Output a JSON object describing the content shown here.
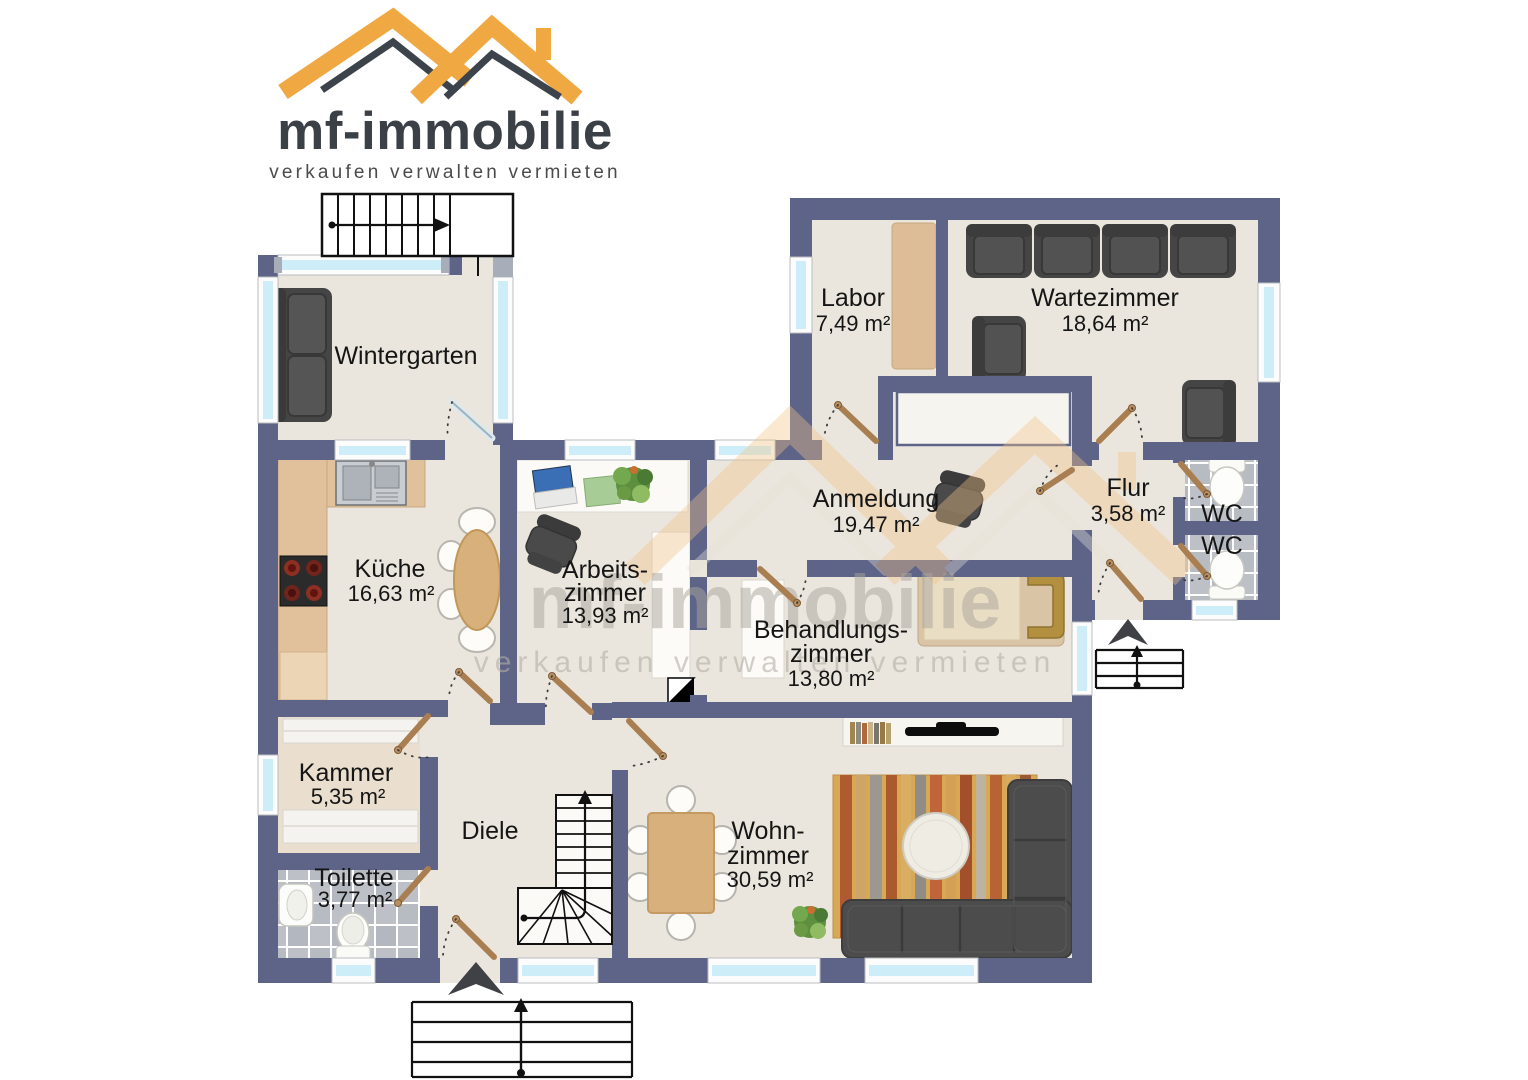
{
  "logo": {
    "title": "mf-immobilie",
    "tagline": "verkaufen verwalten vermieten"
  },
  "watermark": {
    "title": "mf-immobilie",
    "tagline": "verkaufen verwalten vermieten"
  },
  "rooms": {
    "wintergarten": {
      "name": "Wintergarten"
    },
    "labor": {
      "name": "Labor",
      "area": "7,49 m²"
    },
    "wartezimmer": {
      "name": "Wartezimmer",
      "area": "18,64 m²"
    },
    "anmeldung": {
      "name": "Anmeldung",
      "area": "19,47 m²"
    },
    "flur": {
      "name": "Flur",
      "area": "3,58 m²"
    },
    "wc1": {
      "name": "WC"
    },
    "wc2": {
      "name": "WC"
    },
    "kueche": {
      "name": "Küche",
      "area": "16,63 m²"
    },
    "arbeitszimmer": {
      "name_line1": "Arbeits-",
      "name_line2": "zimmer",
      "area": "13,93 m²"
    },
    "behandlungszimmer": {
      "name_line1": "Behandlungs-",
      "name_line2": "zimmer",
      "area": "13,80 m²"
    },
    "kammer": {
      "name": "Kammer",
      "area": "5,35 m²"
    },
    "toilette": {
      "name": "Toilette",
      "area": "3,77 m²"
    },
    "diele": {
      "name": "Diele"
    },
    "wohnzimmer": {
      "name_line1": "Wohn-",
      "name_line2": "zimmer",
      "area": "30,59 m²"
    }
  },
  "colors": {
    "wall": "#5d6488",
    "floor": "#ebe6dd",
    "window_glass": "#cdeef8",
    "wood": "#d8b07c",
    "counter": "#e0c19c",
    "logo_orange": "#f0a843",
    "logo_dark": "#3a4046",
    "furniture_dark": "#4c4c4c",
    "tile": "#bdc0c7"
  }
}
